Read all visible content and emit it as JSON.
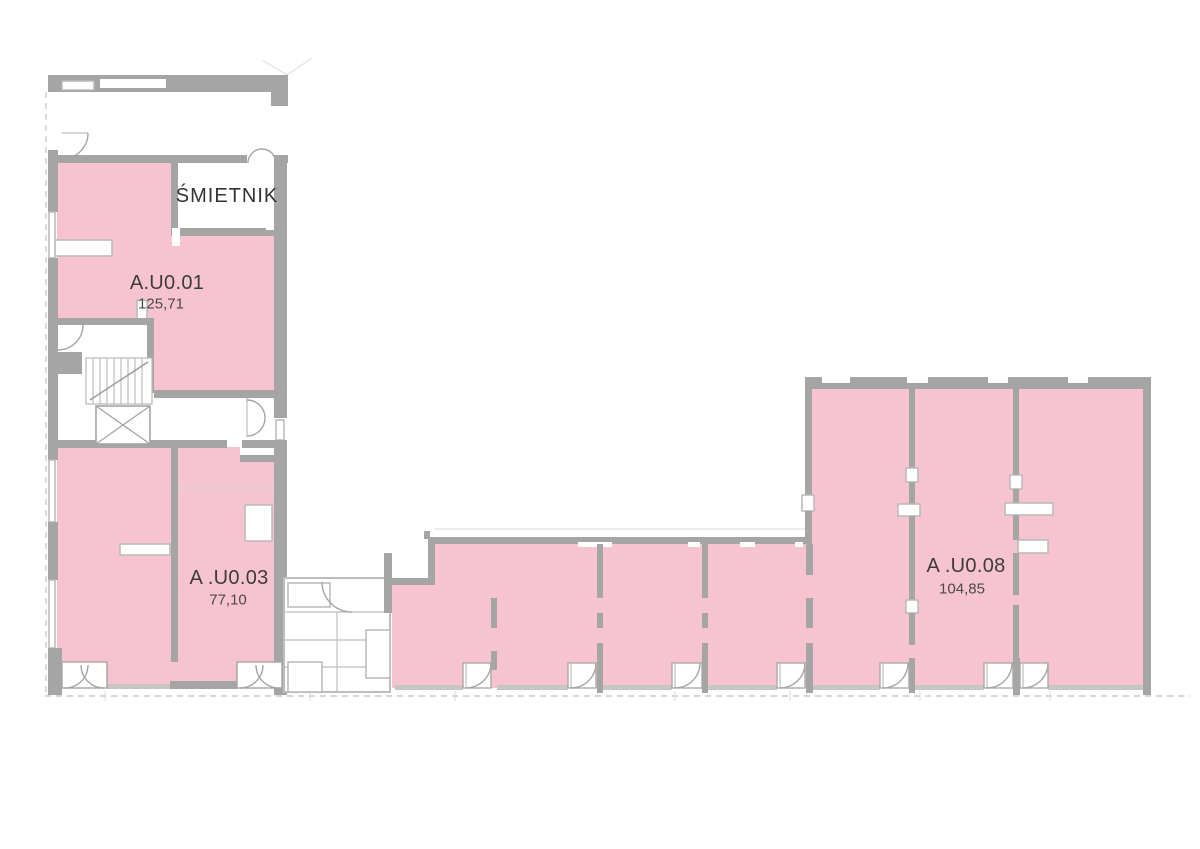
{
  "page": {
    "background": "#ffffff",
    "type": "floor-plan"
  },
  "colors": {
    "unit_fill": "#f8c3d1",
    "wall_gray": "#a5a5a5",
    "light_gray": "#c6c6c6",
    "label_text": "#3c3c3c"
  },
  "rooms": [
    {
      "label": "ŚMIETNIK"
    }
  ],
  "units": [
    {
      "label": "A.U0.01",
      "area": "125,71"
    },
    {
      "label": "A .U0.03",
      "area": "77,10"
    },
    {
      "label": "A .U0.08",
      "area": "104,85"
    }
  ]
}
